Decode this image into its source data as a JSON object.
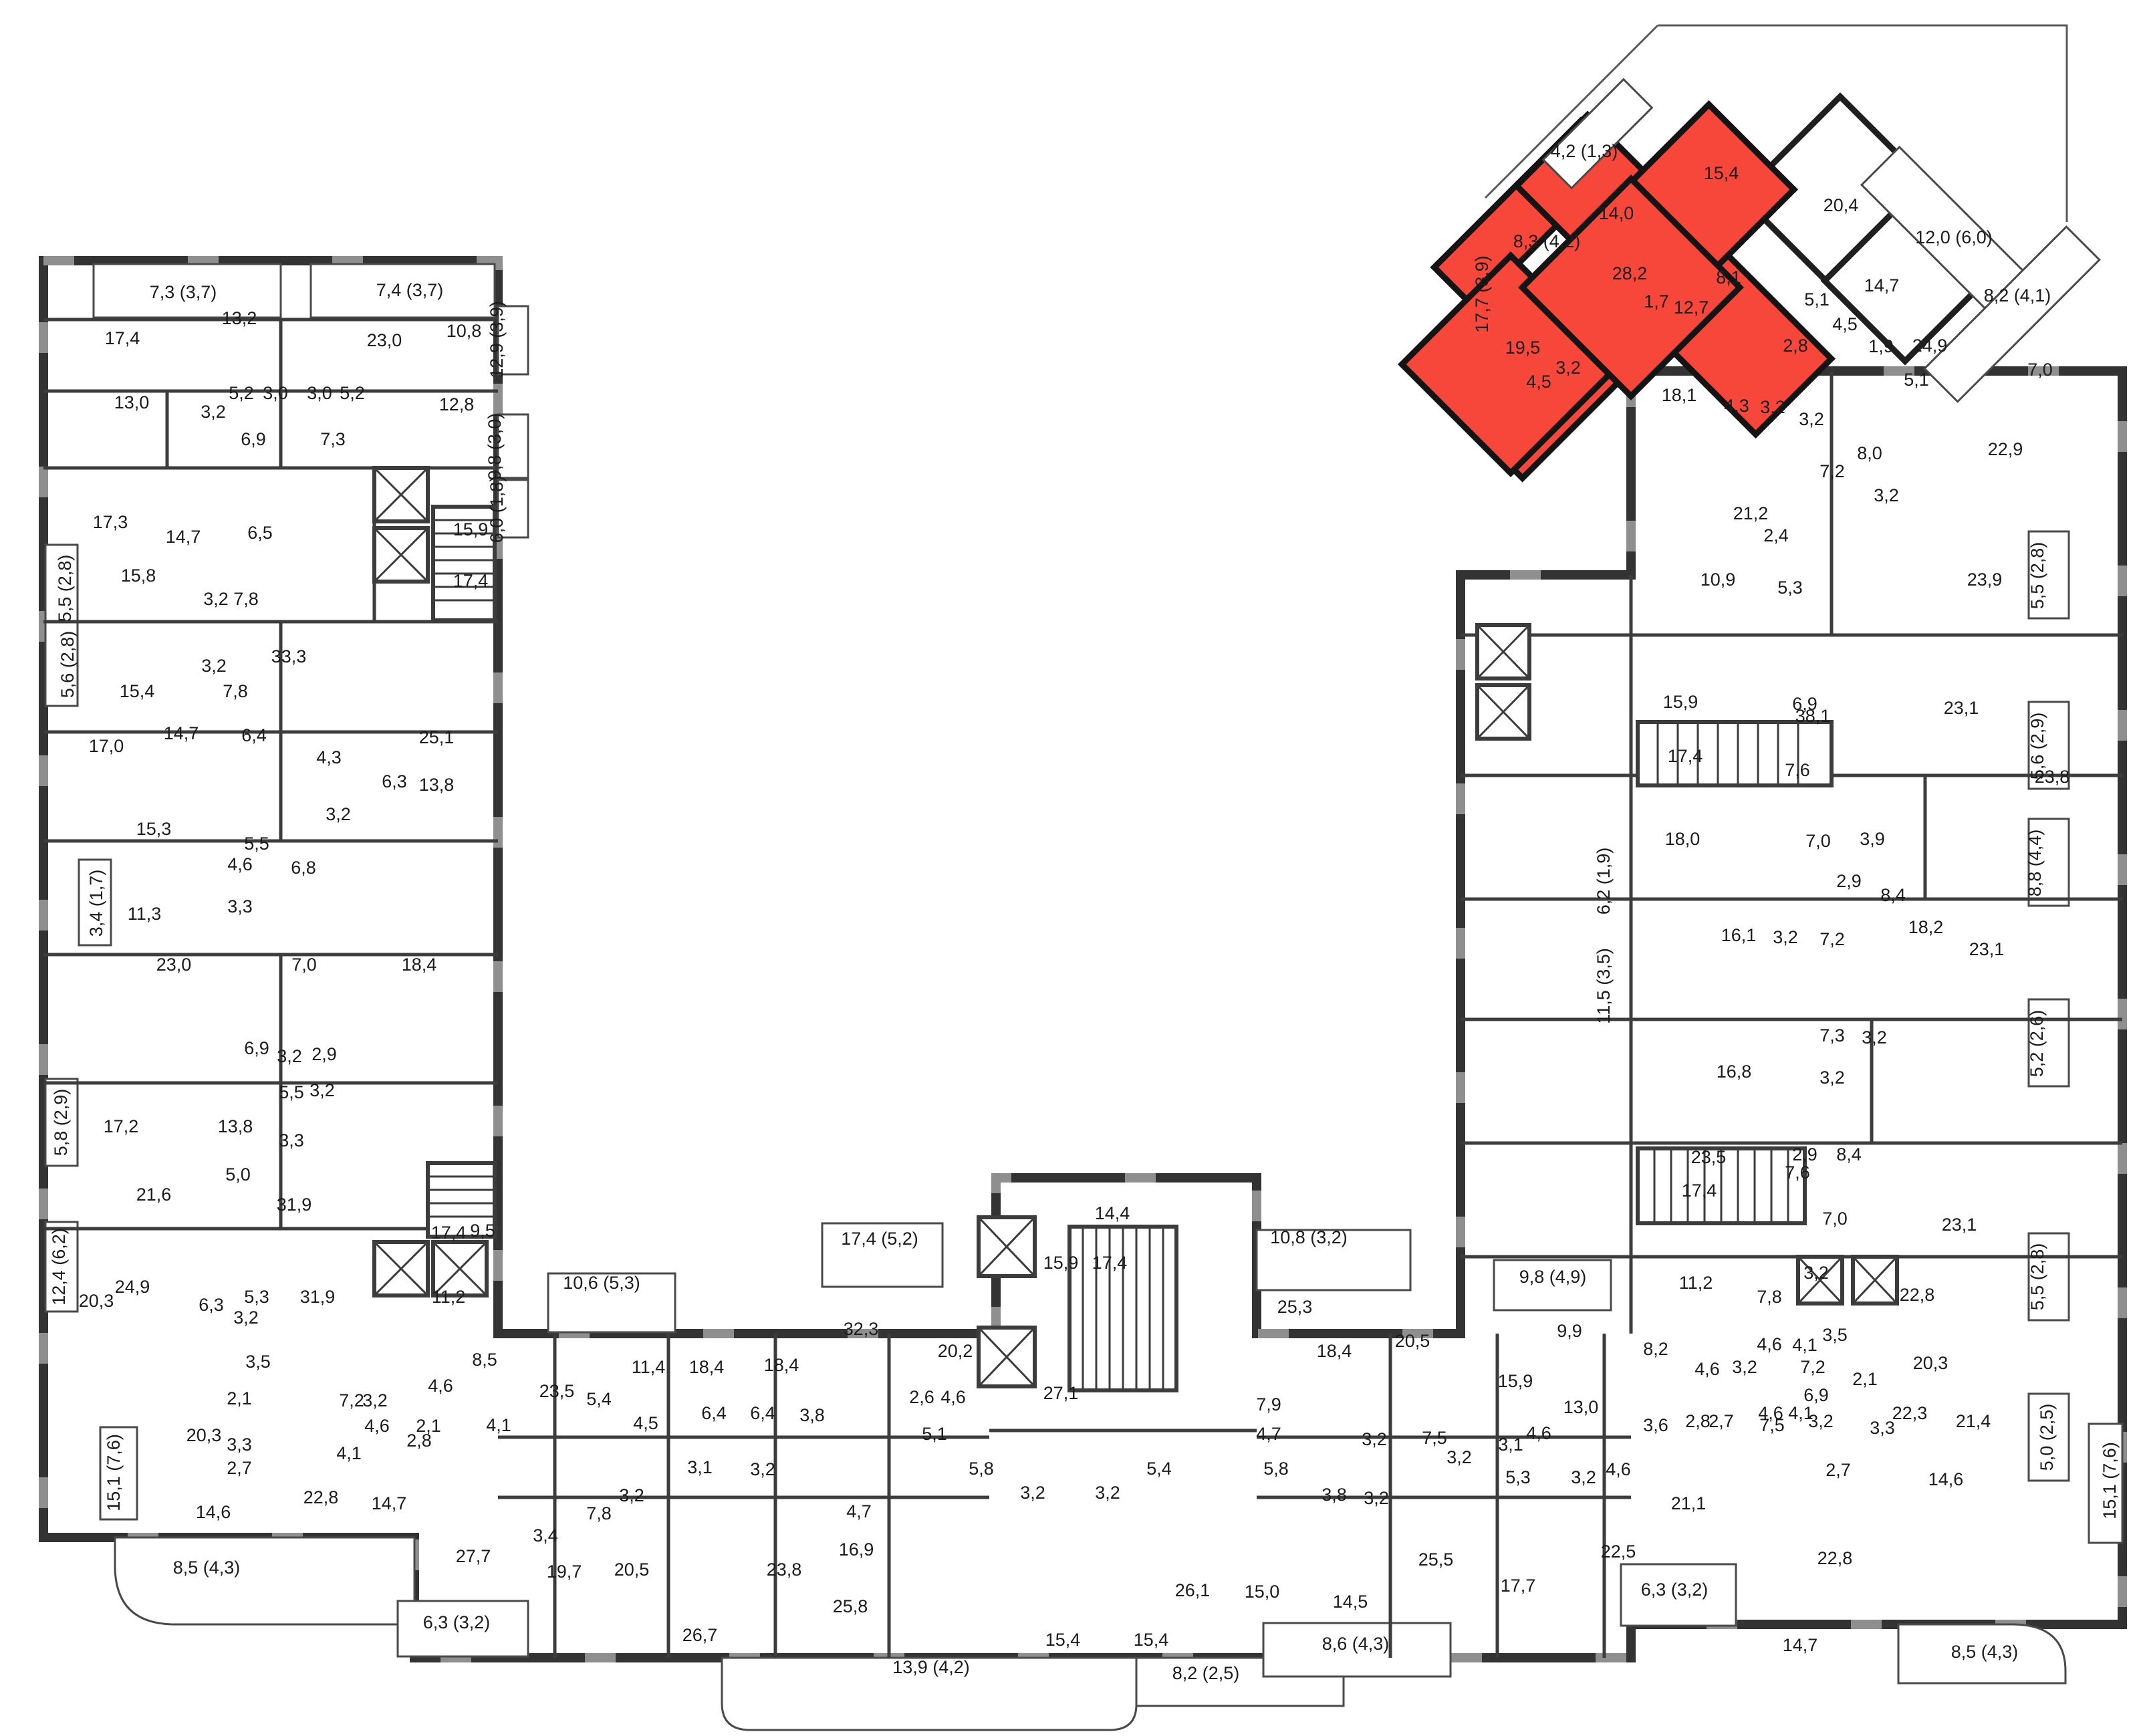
{
  "plan": {
    "type": "residential-floor-plan",
    "highlight_color": "#f7473b",
    "wall_color": "#333333",
    "highlighted_apartment": {
      "rooms": [
        "19,5",
        "28,2",
        "15,4",
        "14,0",
        "12,7",
        "8,1",
        "4,5",
        "3,2",
        "1,7",
        "2,8"
      ],
      "balconies": [
        "8,3 (4,2)",
        "4,2 (1,3)"
      ]
    }
  },
  "labels": [
    [
      274,
      446,
      "7,3 (3,7)"
    ],
    [
      613,
      443,
      "7,4 (3,7)"
    ],
    [
      183,
      515,
      "17,4"
    ],
    [
      358,
      485,
      "13,2"
    ],
    [
      575,
      518,
      "23,0"
    ],
    [
      694,
      504,
      "10,8"
    ],
    [
      361,
      597,
      "5,2"
    ],
    [
      412,
      597,
      "3,0"
    ],
    [
      478,
      597,
      "3,0"
    ],
    [
      527,
      597,
      "5,2"
    ],
    [
      197,
      611,
      "13,0"
    ],
    [
      683,
      614,
      "12,8"
    ],
    [
      319,
      625,
      "3,2"
    ],
    [
      379,
      666,
      "6,9"
    ],
    [
      498,
      666,
      "7,3"
    ],
    [
      704,
      801,
      "15,9"
    ],
    [
      704,
      878,
      "17,4"
    ],
    [
      752,
      508,
      "12,9 (3,9)",
      "v"
    ],
    [
      749,
      668,
      "9,8 (3,0)",
      "v"
    ],
    [
      752,
      762,
      "6,0 (1,8)",
      "v"
    ],
    [
      165,
      790,
      "17,3"
    ],
    [
      274,
      812,
      "14,7"
    ],
    [
      389,
      806,
      "6,5"
    ],
    [
      106,
      880,
      "5,5 (2,8)",
      "v"
    ],
    [
      207,
      870,
      "15,8"
    ],
    [
      323,
      905,
      "3,2"
    ],
    [
      368,
      905,
      "7,8"
    ],
    [
      432,
      991,
      "33,3"
    ],
    [
      110,
      994,
      "5,6 (2,8)",
      "v"
    ],
    [
      205,
      1043,
      "15,4"
    ],
    [
      320,
      1005,
      "3,2"
    ],
    [
      352,
      1043,
      "7,8"
    ],
    [
      271,
      1106,
      "14,7"
    ],
    [
      380,
      1109,
      "6,4"
    ],
    [
      159,
      1125,
      "17,0"
    ],
    [
      653,
      1112,
      "25,1"
    ],
    [
      492,
      1142,
      "4,3"
    ],
    [
      590,
      1178,
      "6,3"
    ],
    [
      653,
      1183,
      "13,8"
    ],
    [
      506,
      1227,
      "3,2"
    ],
    [
      230,
      1249,
      "15,3"
    ],
    [
      384,
      1271,
      "5,5"
    ],
    [
      359,
      1302,
      "4,6"
    ],
    [
      454,
      1307,
      "6,8"
    ],
    [
      153,
      1351,
      "3,4 (1,7)",
      "v"
    ],
    [
      359,
      1365,
      "3,3"
    ],
    [
      216,
      1376,
      "11,3"
    ],
    [
      260,
      1452,
      "23,0"
    ],
    [
      455,
      1452,
      "7,0"
    ],
    [
      627,
      1452,
      "18,4"
    ],
    [
      384,
      1577,
      "6,9"
    ],
    [
      433,
      1589,
      "3,2"
    ],
    [
      485,
      1586,
      "2,9"
    ],
    [
      100,
      1679,
      "5,8 (2,9)",
      "v"
    ],
    [
      181,
      1694,
      "17,2"
    ],
    [
      352,
      1694,
      "13,8"
    ],
    [
      436,
      1643,
      "5,5"
    ],
    [
      482,
      1640,
      "3,2"
    ],
    [
      436,
      1715,
      "3,3"
    ],
    [
      230,
      1796,
      "21,6"
    ],
    [
      356,
      1766,
      "5,0"
    ],
    [
      440,
      1811,
      "31,9"
    ],
    [
      671,
      1853,
      "17,4"
    ],
    [
      722,
      1850,
      "9,5"
    ],
    [
      97,
      1895,
      "12,4 (6,2)",
      "v"
    ],
    [
      198,
      1934,
      "24,9"
    ],
    [
      384,
      1949,
      "5,3"
    ],
    [
      475,
      1949,
      "31,9"
    ],
    [
      671,
      1949,
      "11,2"
    ],
    [
      144,
      1955,
      "20,3"
    ],
    [
      316,
      1961,
      "6,3"
    ],
    [
      368,
      1980,
      "3,2"
    ],
    [
      179,
      2203,
      "15,1 (7,6)",
      "v"
    ],
    [
      386,
      2046,
      "3,5"
    ],
    [
      358,
      2101,
      "2,1"
    ],
    [
      305,
      2156,
      "20,3"
    ],
    [
      358,
      2170,
      "3,3"
    ],
    [
      358,
      2205,
      "2,7"
    ],
    [
      319,
      2271,
      "14,6"
    ],
    [
      309,
      2354,
      "8,5 (4,3)"
    ],
    [
      526,
      2104,
      "7,2"
    ],
    [
      561,
      2104,
      "3,2"
    ],
    [
      659,
      2082,
      "4,6"
    ],
    [
      564,
      2142,
      "4,6"
    ],
    [
      522,
      2183,
      "4,1"
    ],
    [
      641,
      2142,
      "2,1"
    ],
    [
      627,
      2164,
      "2,8"
    ],
    [
      746,
      2141,
      "4,1"
    ],
    [
      725,
      2043,
      "8,5"
    ],
    [
      480,
      2249,
      "22,8"
    ],
    [
      582,
      2258,
      "14,7"
    ],
    [
      708,
      2337,
      "27,7"
    ],
    [
      683,
      2436,
      "6,3 (3,2)"
    ],
    [
      900,
      1928,
      "10,6 (5,3)"
    ],
    [
      833,
      2090,
      "23,5"
    ],
    [
      896,
      2102,
      "5,4"
    ],
    [
      970,
      2054,
      "11,4"
    ],
    [
      1057,
      2054,
      "18,4"
    ],
    [
      1169,
      2051,
      "18,4"
    ],
    [
      1288,
      1997,
      "32,3"
    ],
    [
      1316,
      1862,
      "17,4 (5,2)"
    ],
    [
      966,
      2138,
      "4,5"
    ],
    [
      1068,
      2123,
      "6,4"
    ],
    [
      1141,
      2123,
      "6,4"
    ],
    [
      1215,
      2126,
      "3,8"
    ],
    [
      1379,
      2099,
      "2,6"
    ],
    [
      1047,
      2204,
      "3,1"
    ],
    [
      1141,
      2207,
      "3,2"
    ],
    [
      945,
      2246,
      "3,2"
    ],
    [
      896,
      2273,
      "7,8"
    ],
    [
      816,
      2306,
      "3,4"
    ],
    [
      1285,
      2270,
      "4,7"
    ],
    [
      844,
      2360,
      "19,7"
    ],
    [
      945,
      2357,
      "20,5"
    ],
    [
      1173,
      2357,
      "23,8"
    ],
    [
      1281,
      2327,
      "16,9"
    ],
    [
      1047,
      2455,
      "26,7"
    ],
    [
      1664,
      1824,
      "14,4"
    ],
    [
      1587,
      1898,
      "15,9"
    ],
    [
      1660,
      1898,
      "17,4"
    ],
    [
      1958,
      1860,
      "10,8 (3,2)"
    ],
    [
      1937,
      1964,
      "25,3"
    ],
    [
      1996,
      2030,
      "18,4"
    ],
    [
      1429,
      2030,
      "20,2"
    ],
    [
      1587,
      2093,
      "27,1"
    ],
    [
      1426,
      2099,
      "4,6"
    ],
    [
      1398,
      2154,
      "5,1"
    ],
    [
      1898,
      2110,
      "7,9"
    ],
    [
      1898,
      2154,
      "4,7"
    ],
    [
      2056,
      2162,
      "3,2"
    ],
    [
      1468,
      2206,
      "5,8"
    ],
    [
      1734,
      2206,
      "5,4"
    ],
    [
      1909,
      2206,
      "5,8"
    ],
    [
      1545,
      2242,
      "3,2"
    ],
    [
      1657,
      2242,
      "3,2"
    ],
    [
      1996,
      2245,
      "3,8"
    ],
    [
      2059,
      2250,
      "3,2"
    ],
    [
      1590,
      2462,
      "15,4"
    ],
    [
      1722,
      2462,
      "15,4"
    ],
    [
      1784,
      2388,
      "26,1"
    ],
    [
      1888,
      2390,
      "15,0"
    ],
    [
      2020,
      2405,
      "14,5"
    ],
    [
      2028,
      2468,
      "8,6 (4,3)"
    ],
    [
      1804,
      2512,
      "8,2 (2,5)"
    ],
    [
      1393,
      2503,
      "13,9 (4,2)"
    ],
    [
      1272,
      2412,
      "25,8"
    ],
    [
      2323,
      1919,
      "9,8 (4,9)"
    ],
    [
      2537,
      1928,
      "11,2"
    ],
    [
      2348,
      2000,
      "9,9"
    ],
    [
      2113,
      2015,
      "20,5"
    ],
    [
      2267,
      2075,
      "15,9"
    ],
    [
      2365,
      2114,
      "13,0"
    ],
    [
      2477,
      2027,
      "8,2"
    ],
    [
      2554,
      2057,
      "4,6"
    ],
    [
      2610,
      2054,
      "3,2"
    ],
    [
      2712,
      2054,
      "7,2"
    ],
    [
      2477,
      2141,
      "3,6"
    ],
    [
      2540,
      2135,
      "2,8"
    ],
    [
      2575,
      2135,
      "2,7"
    ],
    [
      2649,
      2123,
      "4,6"
    ],
    [
      2694,
      2123,
      "4,1"
    ],
    [
      2146,
      2160,
      "7,5"
    ],
    [
      2260,
      2170,
      "3,1"
    ],
    [
      2302,
      2153,
      "4,6"
    ],
    [
      2183,
      2189,
      "3,2"
    ],
    [
      2271,
      2219,
      "5,3"
    ],
    [
      2369,
      2219,
      "3,2"
    ],
    [
      2421,
      2207,
      "4,6"
    ],
    [
      2526,
      2258,
      "21,1"
    ],
    [
      2148,
      2342,
      "25,5"
    ],
    [
      2271,
      2381,
      "17,7"
    ],
    [
      2421,
      2330,
      "22,5"
    ],
    [
      2505,
      2387,
      "6,3 (3,2)"
    ],
    [
      2693,
      2470,
      "14,7"
    ],
    [
      2745,
      2340,
      "22,8"
    ],
    [
      2969,
      2480,
      "8,5 (4,3)"
    ],
    [
      3165,
      2215,
      "15,1 (7,6)",
      "v"
    ],
    [
      2370,
      235,
      "4,2 (1,3)"
    ],
    [
      2314,
      370,
      "8,3 (4,2)"
    ],
    [
      2418,
      328,
      "14,0"
    ],
    [
      2575,
      268,
      "15,4"
    ],
    [
      2438,
      418,
      "28,2"
    ],
    [
      2586,
      424,
      "8,1"
    ],
    [
      2478,
      460,
      "1,7"
    ],
    [
      2530,
      469,
      "12,7"
    ],
    [
      2278,
      529,
      "19,5"
    ],
    [
      2346,
      559,
      "3,2"
    ],
    [
      2302,
      580,
      "4,5"
    ],
    [
      2686,
      526,
      "2,8"
    ],
    [
      2754,
      316,
      "20,4"
    ],
    [
      2923,
      364,
      "12,0 (6,0)"
    ],
    [
      2815,
      436,
      "14,7"
    ],
    [
      3018,
      451,
      "8,2 (4,1)"
    ],
    [
      2718,
      457,
      "5,1"
    ],
    [
      2760,
      494,
      "4,5"
    ],
    [
      2814,
      527,
      "1,9"
    ],
    [
      2887,
      526,
      "24,9"
    ],
    [
      2867,
      577,
      "5,1"
    ],
    [
      3052,
      562,
      "7,0"
    ],
    [
      2226,
      440,
      "17,7 (8,9)",
      "v"
    ],
    [
      2512,
      600,
      "18,1"
    ],
    [
      2598,
      616,
      "4,3"
    ],
    [
      2652,
      618,
      "3,2"
    ],
    [
      2619,
      777,
      "21,2"
    ],
    [
      2657,
      810,
      "2,4"
    ],
    [
      2570,
      876,
      "10,9"
    ],
    [
      2678,
      888,
      "5,3"
    ],
    [
      2710,
      636,
      "3,2"
    ],
    [
      2797,
      687,
      "8,0"
    ],
    [
      3000,
      681,
      "22,9"
    ],
    [
      2741,
      714,
      "7,2"
    ],
    [
      2969,
      876,
      "23,9"
    ],
    [
      2822,
      750,
      "3,2"
    ],
    [
      3057,
      861,
      "5,5 (2,8)",
      "v"
    ],
    [
      3057,
      1116,
      "5,6 (2,9)",
      "v"
    ],
    [
      2700,
      1062,
      "6,9"
    ],
    [
      2934,
      1068,
      "23,1"
    ],
    [
      2689,
      1161,
      "7,6"
    ],
    [
      2514,
      1059,
      "15,9"
    ],
    [
      2712,
      1080,
      "38,1"
    ],
    [
      2521,
      1140,
      "17,4"
    ],
    [
      2408,
      1318,
      "6,2 (1,9)",
      "v"
    ],
    [
      2408,
      1475,
      "11,5 (3,5)",
      "v"
    ],
    [
      2517,
      1264,
      "18,0"
    ],
    [
      2720,
      1267,
      "7,0"
    ],
    [
      2801,
      1264,
      "3,9"
    ],
    [
      2766,
      1327,
      "2,9"
    ],
    [
      2832,
      1348,
      "8,4"
    ],
    [
      3070,
      1171,
      "23,8"
    ],
    [
      3053,
      1291,
      "8,8 (4,4)",
      "v"
    ],
    [
      2601,
      1408,
      "16,1"
    ],
    [
      2671,
      1411,
      "3,2"
    ],
    [
      2741,
      1414,
      "7,2"
    ],
    [
      2881,
      1396,
      "18,2"
    ],
    [
      2972,
      1429,
      "23,1"
    ],
    [
      3056,
      1561,
      "5,2 (2,6)",
      "v"
    ],
    [
      2594,
      1612,
      "16,8"
    ],
    [
      2741,
      1558,
      "7,3"
    ],
    [
      2804,
      1561,
      "3,2"
    ],
    [
      2741,
      1621,
      "3,2"
    ],
    [
      2556,
      1740,
      "23,5"
    ],
    [
      2700,
      1736,
      "2,9"
    ],
    [
      2766,
      1736,
      "8,4"
    ],
    [
      2689,
      1763,
      "7,6"
    ],
    [
      2931,
      1841,
      "23,1"
    ],
    [
      3057,
      1910,
      "5,5 (2,8)",
      "v"
    ],
    [
      2647,
      1949,
      "7,8"
    ],
    [
      2717,
      1913,
      "3,2"
    ],
    [
      2868,
      1946,
      "22,8"
    ],
    [
      2717,
      2096,
      "6,9"
    ],
    [
      2857,
      2123,
      "22,3"
    ],
    [
      3071,
      2150,
      "5,0 (2,5)",
      "v"
    ],
    [
      2542,
      1790,
      "17,4"
    ],
    [
      2745,
      1832,
      "7,0"
    ],
    [
      2745,
      2006,
      "3,5"
    ],
    [
      2888,
      2048,
      "20,3"
    ],
    [
      2790,
      2072,
      "2,1"
    ],
    [
      2816,
      2145,
      "3,3"
    ],
    [
      2750,
      2208,
      "2,7"
    ],
    [
      2911,
      2222,
      "14,6"
    ],
    [
      2647,
      2020,
      "4,6"
    ],
    [
      2700,
      2021,
      "4,1"
    ],
    [
      2651,
      2141,
      "7,5"
    ],
    [
      2724,
      2135,
      "3,2"
    ],
    [
      2952,
      2135,
      "21,4"
    ]
  ]
}
